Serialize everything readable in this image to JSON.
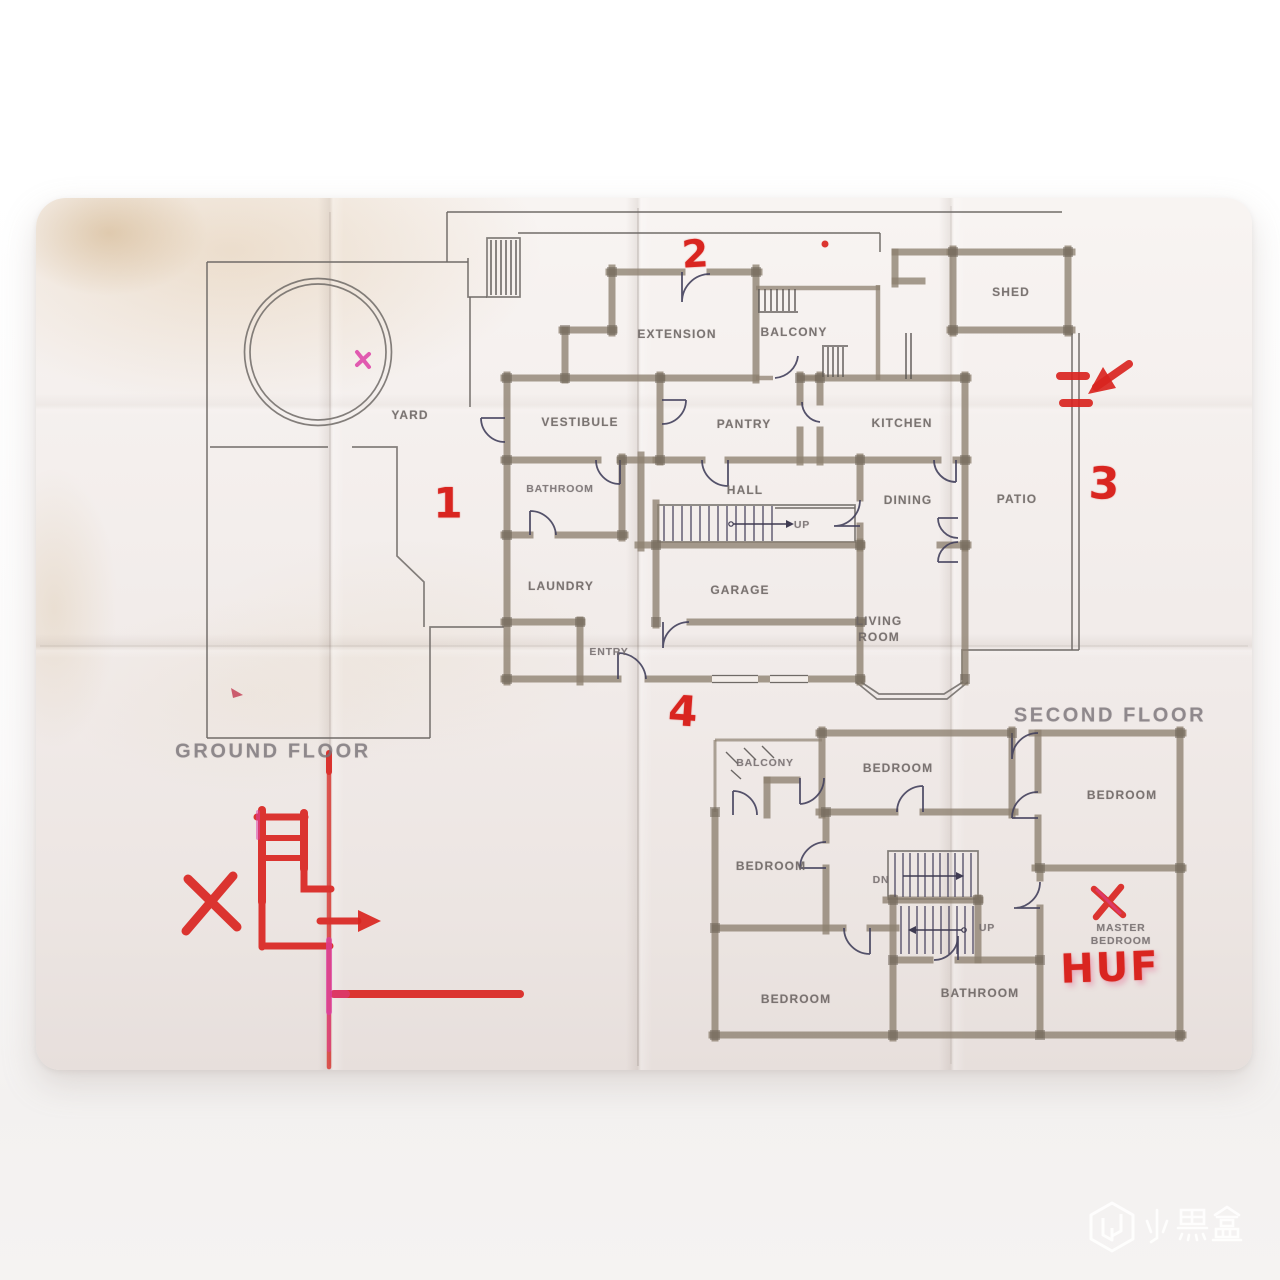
{
  "ground": {
    "title": "GROUND FLOOR",
    "labels": {
      "yard": "YARD",
      "extension": "EXTENSION",
      "balcony": "BALCONY",
      "shed": "SHED",
      "vestibule": "VESTIBULE",
      "pantry": "PANTRY",
      "kitchen": "KITCHEN",
      "bathroom": "BATHROOM",
      "hall": "HALL",
      "stairs_up": "UP",
      "dining": "DINING",
      "patio": "PATIO",
      "laundry": "LAUNDRY",
      "garage": "GARAGE",
      "living_line1": "LIVING",
      "living_line2": "ROOM",
      "entry": "ENTRY"
    }
  },
  "second": {
    "title": "SECOND FLOOR",
    "labels": {
      "balcony": "BALCONY",
      "bedroom_top": "BEDROOM",
      "bedroom_right": "BEDROOM",
      "bedroom_left": "BEDROOM",
      "bedroom_bottom": "BEDROOM",
      "stairs_dn": "DN",
      "stairs_up": "UP",
      "master_line1": "MASTER",
      "master_line2": "BEDROOM",
      "bathroom": "BATHROOM"
    }
  },
  "annotations": {
    "marker_color": "#d92520",
    "accent_color": "#dd3fa6",
    "number_1": "1",
    "number_2": "2",
    "number_3": "3",
    "number_4": "4",
    "huf": "HUF",
    "symbols": [
      "dashed-arrow-left",
      "x-mark-master",
      "x-mark-left",
      "ladder-scribble",
      "arrow-right",
      "fold-red-line",
      "horizontal-red-line",
      "red-dot",
      "pink-pool-mark",
      "pink-yard-mark"
    ]
  },
  "watermark": {
    "text": "小黑盒",
    "logo": "xiaoheihe-logo"
  }
}
